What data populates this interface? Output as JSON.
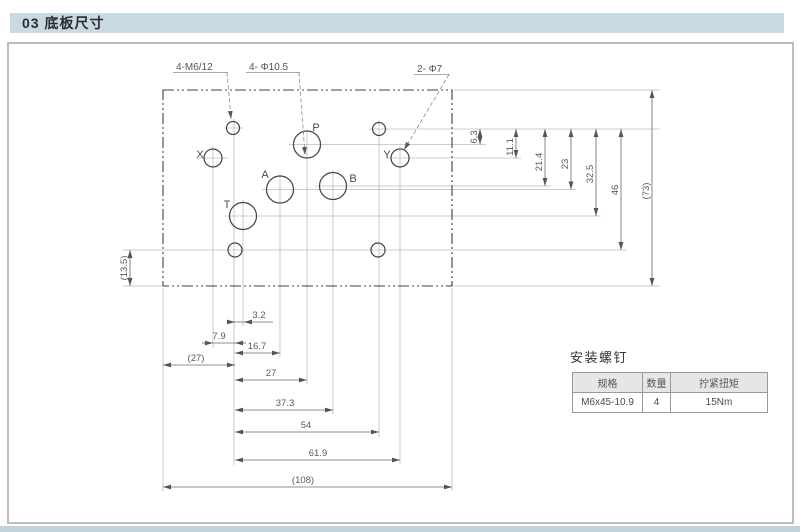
{
  "header": {
    "title": "03 底板尺寸"
  },
  "drawing": {
    "callouts": {
      "mounting_holes": "4-M6/12",
      "main_ports": "4- Φ10.5",
      "pilot_ports": "2- Φ7"
    },
    "ports": {
      "p": "P",
      "x": "X",
      "y": "Y",
      "a": "A",
      "b": "B",
      "t": "T"
    },
    "dims": {
      "right": [
        "6.3",
        "11.1",
        "21.4",
        "23",
        "32.5",
        "46",
        "(73)"
      ],
      "bottom": [
        "3.2",
        "7.9",
        "16.7",
        "(27)",
        "27",
        "37.3",
        "54",
        "61.9",
        "(108)"
      ],
      "left": [
        "(13.5)"
      ]
    }
  },
  "screw_table": {
    "title": "安装螺钉",
    "headers": [
      "规格",
      "数量",
      "拧紧扭矩"
    ],
    "rows": [
      [
        "M6x45-10.9",
        "4",
        "15Nm"
      ]
    ]
  },
  "colors": {
    "section_bar": "#c8d9e2",
    "bottom_bar": "#c2d2da",
    "table_header_bg": "#e6e6e6",
    "line_dark": "#3f3f3f",
    "line_dim": "#6e6e6e",
    "line_extension": "#bbbbbb"
  }
}
